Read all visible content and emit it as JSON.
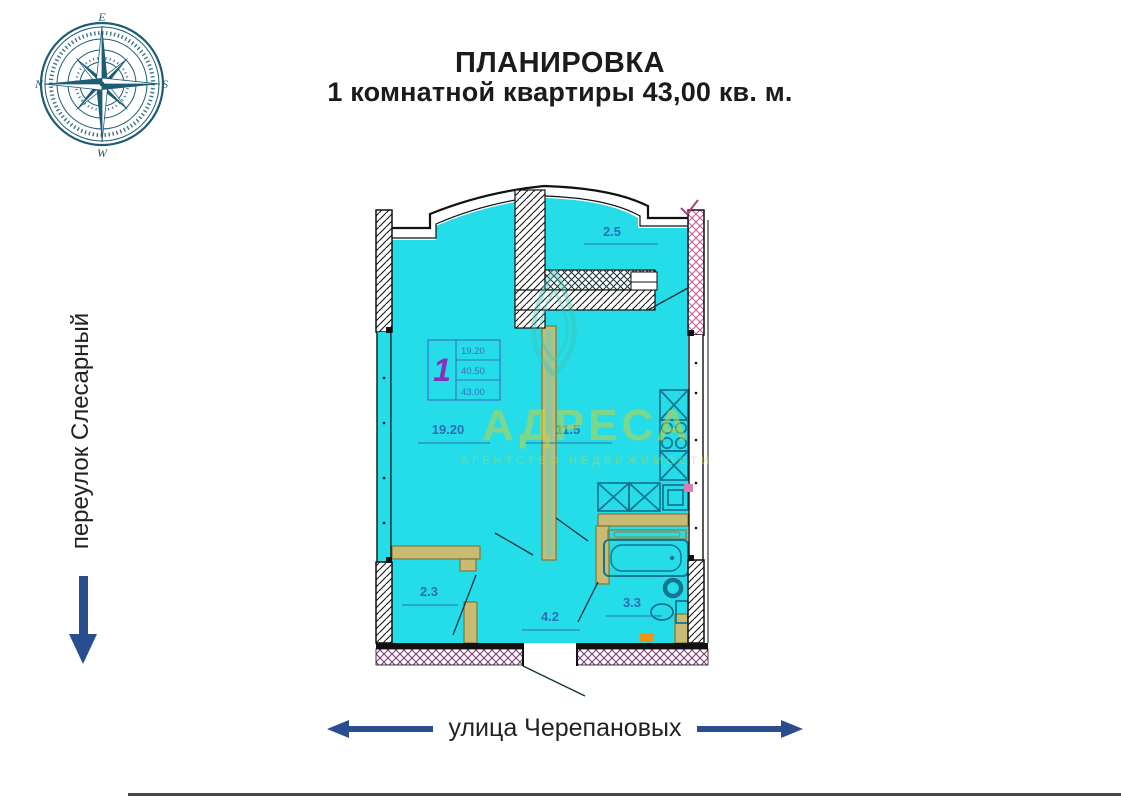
{
  "title": {
    "line1": "ПЛАНИРОВКА",
    "line2": "1 комнатной квартиры 43,00 кв. м."
  },
  "compass": {
    "top": "E",
    "right": "S",
    "bottom": "W",
    "left": "N"
  },
  "streets": {
    "left": "переулок Слесарный",
    "bottom": "улица Черепановых"
  },
  "watermark": {
    "name": "АДРЕСА",
    "tagline": "АГЕНТСТВО НЕДВИЖИМОСТИ"
  },
  "plan": {
    "rooms": [
      {
        "id": "balcony",
        "area": "2.5"
      },
      {
        "id": "living-room",
        "area": "19.20"
      },
      {
        "id": "kitchen",
        "area": "11.5"
      },
      {
        "id": "wardrobe",
        "area": "2.3"
      },
      {
        "id": "hallway",
        "area": "4.2"
      },
      {
        "id": "bathroom",
        "area": "3.3"
      }
    ],
    "stamp": {
      "rooms_count": "1",
      "living_area": "19.20",
      "floor_area": "40.50",
      "total_area": "43.00"
    }
  },
  "colors": {
    "plan_fill": "#24dde8",
    "partition": "#c9ba74",
    "fixtures": "#13758f",
    "room_label": "#2b6fb8",
    "stamp_number": "#8a2fb8",
    "watermark": "#c9d23f",
    "arrow": "#2a4d8f",
    "compass": "#1d5c74",
    "wall_hatch_pink": "#c2558f",
    "bottom_wall_hatch": "#7c2f73",
    "accent_orange": "#f0930f"
  }
}
